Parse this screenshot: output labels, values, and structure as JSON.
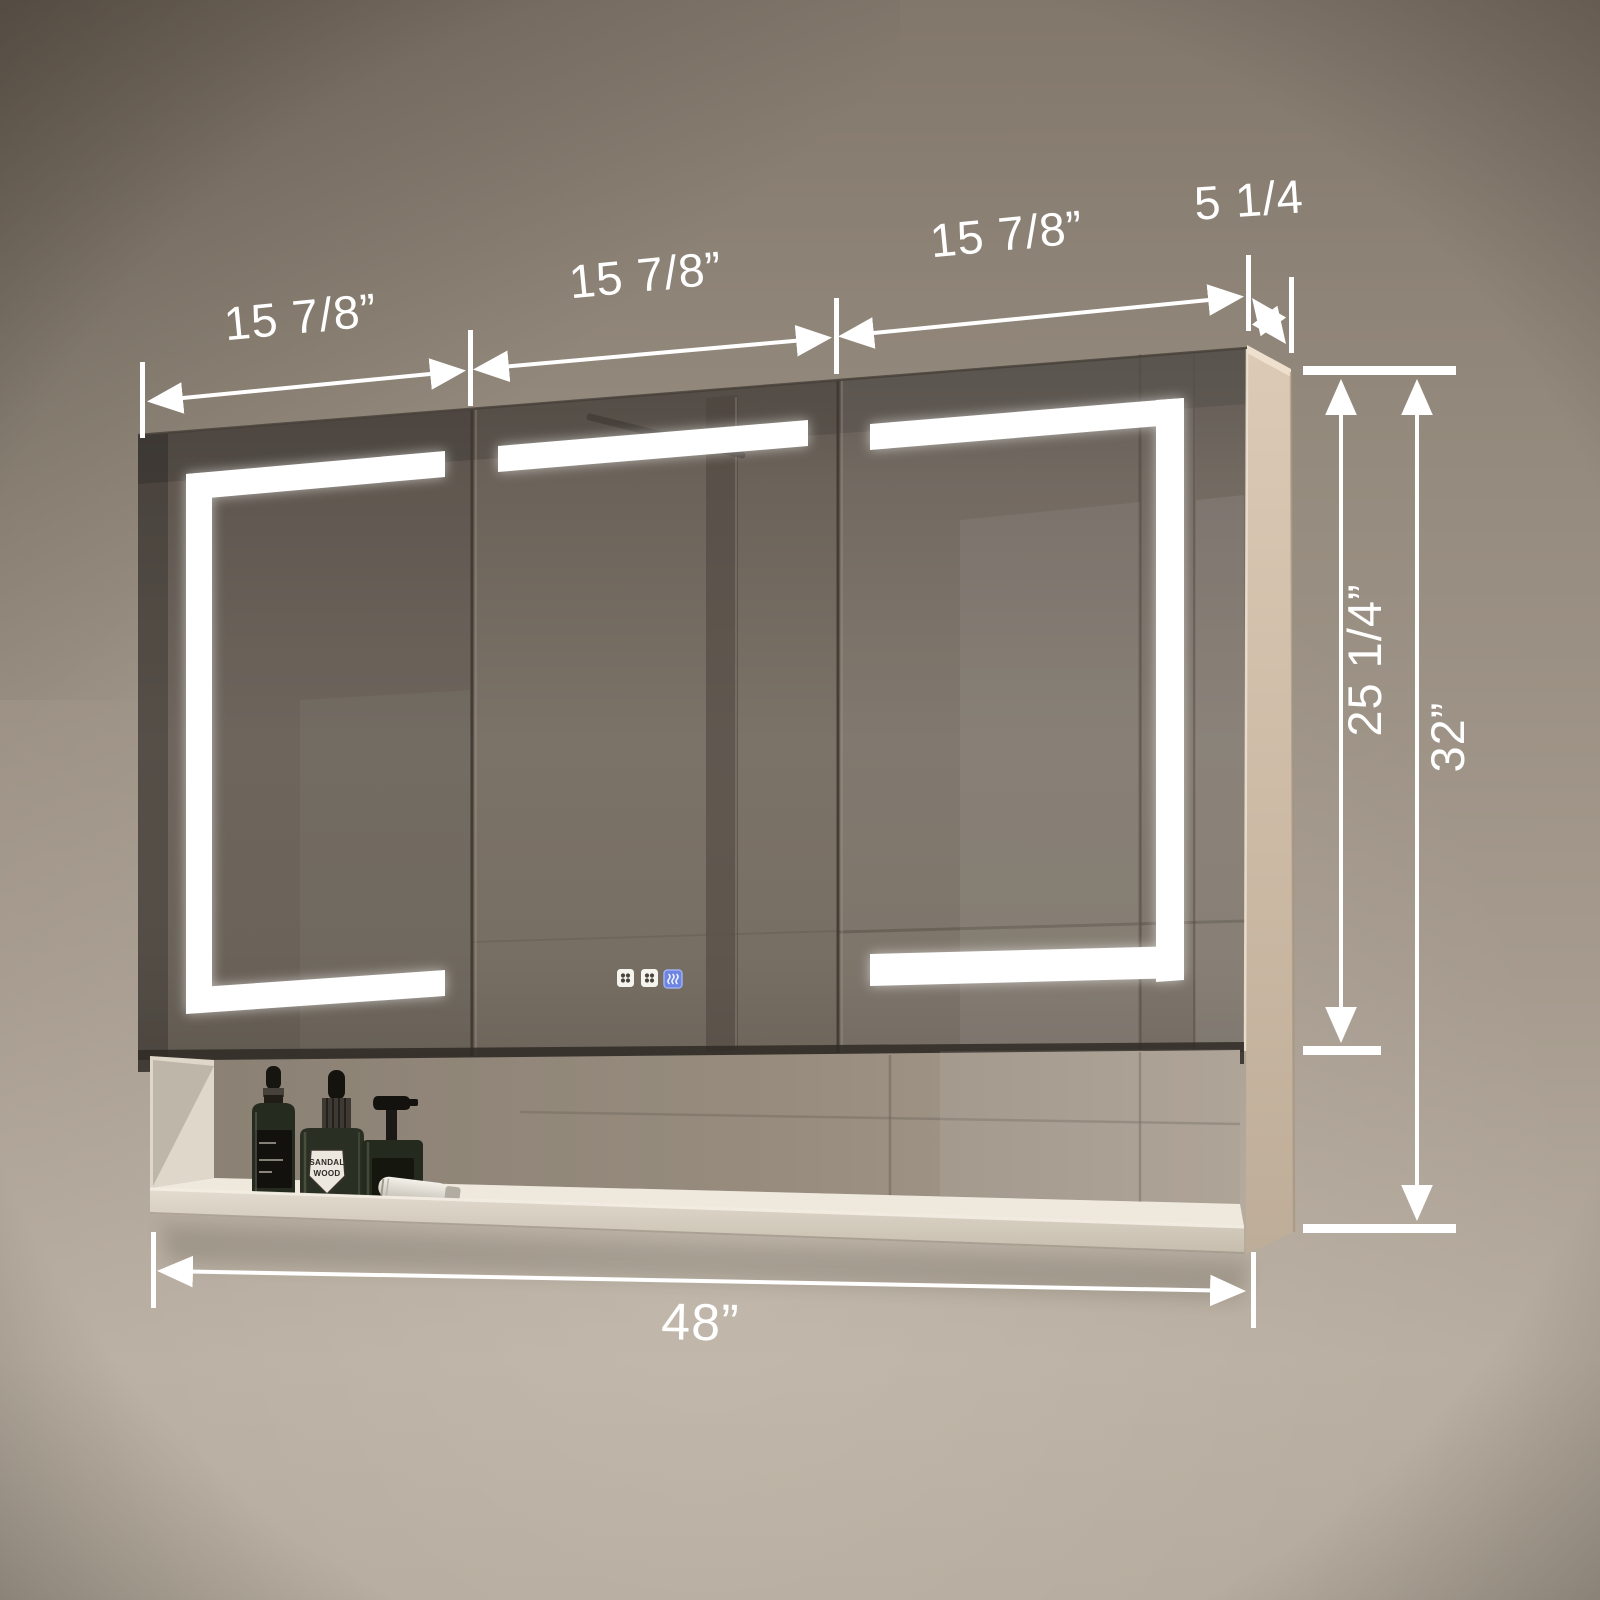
{
  "dimensions": {
    "door_width_left": "15 7/8”",
    "door_width_middle": "15 7/8”",
    "door_width_right": "15 7/8”",
    "depth": "5 1/4",
    "mirror_height": "25 1/4”",
    "overall_height": "32”",
    "overall_width": "48”"
  },
  "bottle_label": {
    "line1": "SANDAL",
    "line2": "WOOD"
  },
  "icons": {
    "touch_button_1": "clover-touch-icon",
    "touch_button_2": "clover-touch-icon",
    "touch_button_3": "defog-touch-icon"
  },
  "colors": {
    "dimension_lines": "#ffffff",
    "led_strip": "#ffffff",
    "wall": "#998e81",
    "mirror": "#6f665c",
    "cabinet_side": "#d3c1ad",
    "defog_button": "#6d84e2"
  }
}
